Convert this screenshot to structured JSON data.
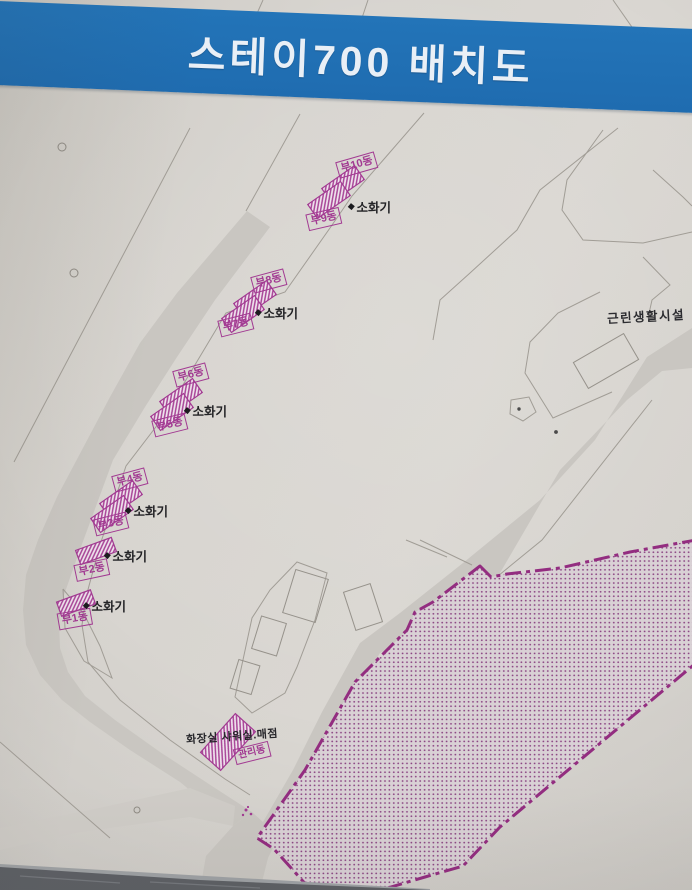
{
  "title": "스테이700 배치도",
  "map": {
    "units": [
      {
        "label": "부1동"
      },
      {
        "label": "부2동"
      },
      {
        "label": "부3동"
      },
      {
        "label": "부4동"
      },
      {
        "label": "부5동"
      },
      {
        "label": "부6동"
      },
      {
        "label": "부7동"
      },
      {
        "label": "부8동"
      },
      {
        "label": "부9동"
      },
      {
        "label": "부10동"
      }
    ],
    "fire_extinguisher": "소화기",
    "neighborhood_facility": "근린생활시설",
    "amenities": "화장실 샤워실.매점",
    "management_office": "관리동"
  },
  "colors": {
    "banner_blue": "#2070b4",
    "magenta": "#a23a92",
    "restricted_border": "#932d80",
    "board_background": "#d6d3ce",
    "road_gray": "#c9c6c1"
  }
}
